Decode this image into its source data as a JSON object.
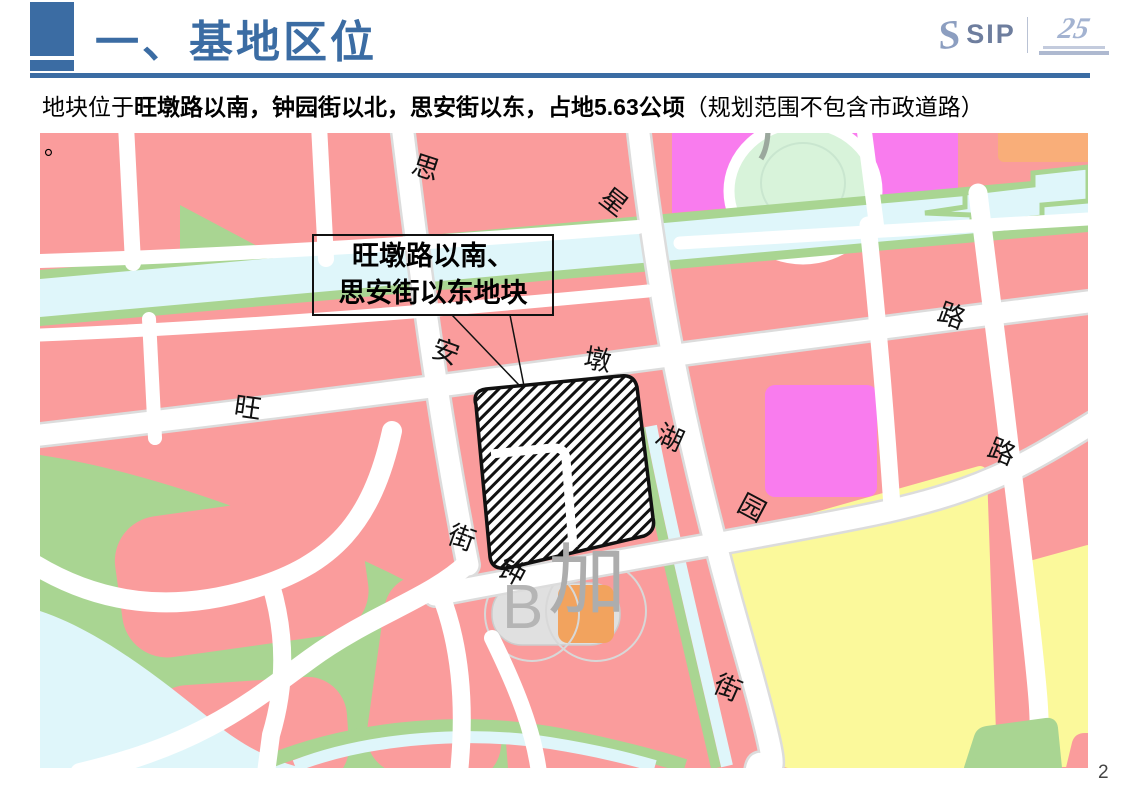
{
  "slide": {
    "page_number": "2"
  },
  "header": {
    "title": "一、基地区位",
    "accent_color": "#3B6CA3",
    "logo": {
      "sip": "SIP",
      "anniversary": "25"
    }
  },
  "body": {
    "intro": "地块位于",
    "bold": "旺墩路以南，钟园街以北，思安街以东，占地5.63公顷",
    "tail": "（规划范围不包含市政道路）",
    "line2": "。"
  },
  "map": {
    "callout": {
      "line1": "旺墩路以南、",
      "line2": "思安街以东地块"
    },
    "road_labels": [
      "思",
      "安",
      "街",
      "星",
      "湖",
      "街",
      "旺",
      "墩",
      "路",
      "钟",
      "园",
      "路"
    ],
    "watermark": {
      "factory": "厂",
      "b": "B",
      "jia": "加"
    },
    "colors": {
      "salmon": "#FA9C9C",
      "green": "#A9D592",
      "cyan": "#DFF6FA",
      "magenta": "#F97CEE",
      "yellow": "#FBF99B",
      "orange": "#F9AE79",
      "wmOrange": "#F2A35E",
      "park": "#D8F3DA",
      "roadCase": "#DCDCDC"
    }
  }
}
